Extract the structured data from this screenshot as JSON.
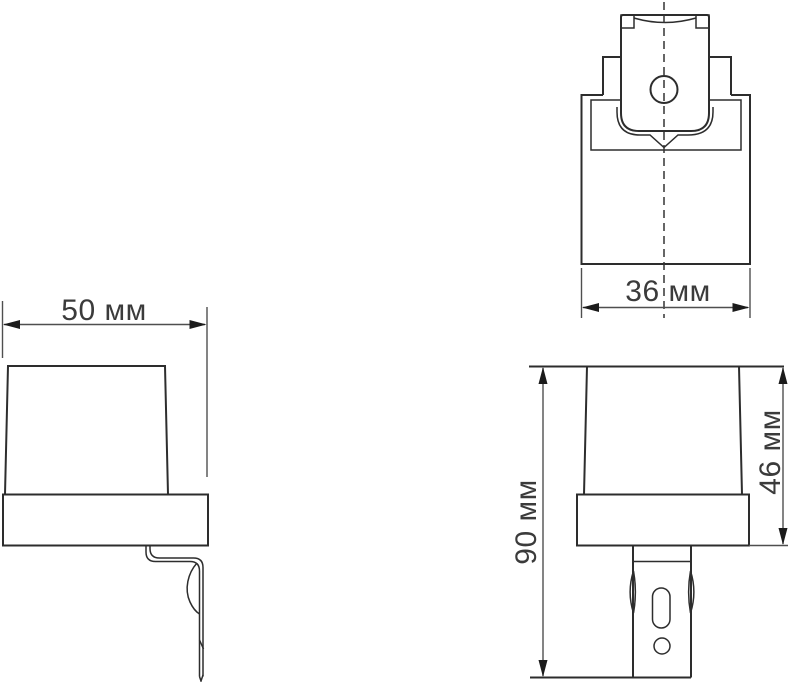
{
  "drawing": {
    "kind": "technical-dimension-drawing",
    "views": {
      "top_view": "top view",
      "front_view": "front view",
      "side_view": "side view"
    },
    "dimensions": {
      "front_width": "50 мм",
      "top_width": "36 мм",
      "overall_height": "90 мм",
      "body_height": "46 мм"
    },
    "colors": {
      "background": "#ffffff",
      "outline": "#2d2d2d",
      "dimension_line": "#4f4f4f",
      "arrow": "#1b1b1b",
      "text": "#3b3b3b"
    }
  }
}
